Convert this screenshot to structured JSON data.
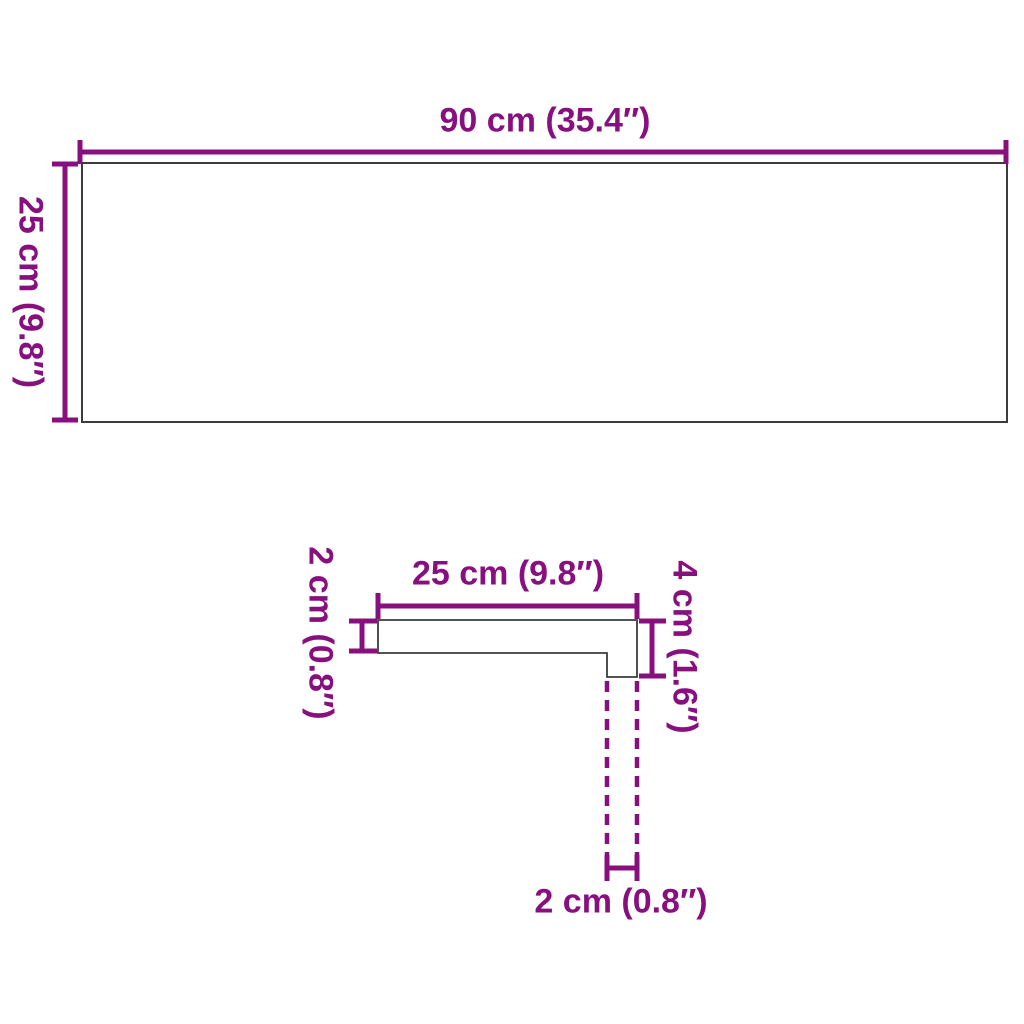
{
  "colors": {
    "dimension_magenta": "#87107E",
    "outline_gray": "#3C3C3C",
    "background": "#FFFFFF"
  },
  "top_view": {
    "width_label": "90 cm (35.4″)",
    "depth_label": "25 cm (9.8″)"
  },
  "profile_view": {
    "top_width_label": "25 cm (9.8″)",
    "thickness_label": "2 cm (0.8″)",
    "nose_height_label": "4 cm (1.6″)",
    "nose_width_label": "2 cm (0.8″)"
  }
}
